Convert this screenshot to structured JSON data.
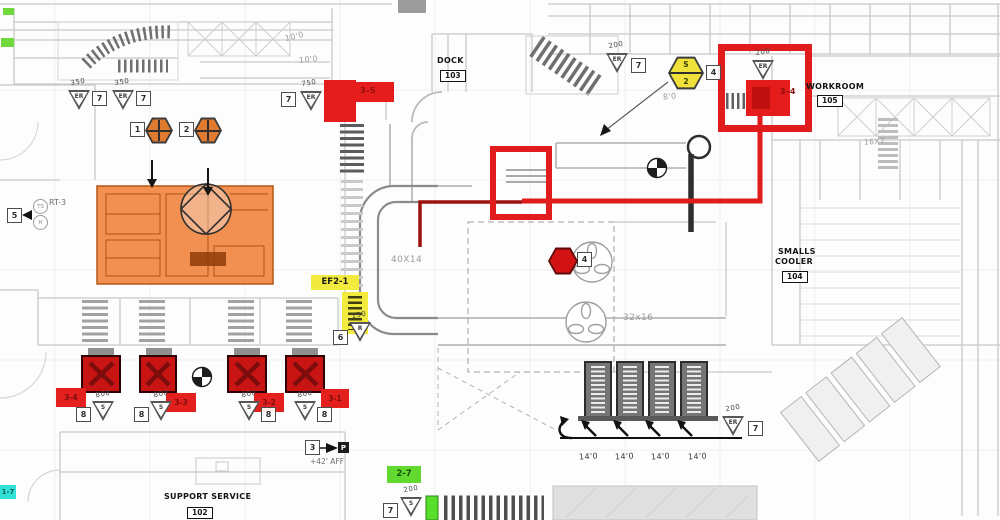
{
  "rooms": {
    "dock": {
      "name": "DOCK",
      "number": "103"
    },
    "workroom": {
      "name": "WORKROOM",
      "number": "105"
    },
    "smalls_cooler": {
      "line1": "SMALLS",
      "line2": "COOLER",
      "number": "104"
    },
    "support_service": {
      "name": "SUPPORT SERVICE",
      "number": "102"
    }
  },
  "dims": {
    "d10a": "10'0",
    "d10b": "10'0",
    "d8": "8'0",
    "d40x14": "40X14",
    "d32x16": "32x16",
    "d16x7": "16X7",
    "d14a": "14'0",
    "d14b": "14'0",
    "d14c": "14'0",
    "d14d": "14'0",
    "aff": "+42' AFF"
  },
  "equip": {
    "rt3": "RT-3",
    "ts": "TS",
    "h": "H",
    "p": "P"
  },
  "keynotes": {
    "k1": "1",
    "k2": "2",
    "k3": "3",
    "k4a": "4",
    "k4b": "4",
    "k5": "5"
  },
  "tags": {
    "ef": "EF2-1",
    "green": "2-7",
    "cyan": "1-7",
    "red35": "3-5",
    "red34": "3-4",
    "hood1": "3-4",
    "hood2": "3-3",
    "hood3": "3-2",
    "hood4": "3-1"
  },
  "hex_yellow": {
    "top": "S",
    "bottom": "2"
  },
  "diffusers": [
    {
      "cfm": "350",
      "type": "ER",
      "key": "7"
    },
    {
      "cfm": "350",
      "type": "ER",
      "key": "7"
    },
    {
      "cfm": "750",
      "type": "ER",
      "key": "7"
    },
    {
      "cfm": "200",
      "type": "ER",
      "key": "7"
    },
    {
      "cfm": "200",
      "type": "ER",
      "key": ""
    },
    {
      "cfm": "150",
      "type": "R",
      "key": "6"
    },
    {
      "cfm": "800",
      "type": "S",
      "key": "8"
    },
    {
      "cfm": "800",
      "type": "S",
      "key": "8"
    },
    {
      "cfm": "800",
      "type": "S",
      "key": "8"
    },
    {
      "cfm": "800",
      "type": "S",
      "key": "8"
    },
    {
      "cfm": "200",
      "type": "S",
      "key": "7"
    },
    {
      "cfm": "200",
      "type": "ER",
      "key": "7"
    }
  ],
  "colors": {
    "markup_red": "#e01c1c",
    "hood_red": "#c91414",
    "island_orange": "#ee7d31",
    "highlight_yellow": "#f2ea3c",
    "highlight_green": "#62d92e",
    "highlight_cyan": "#30e2d8"
  }
}
